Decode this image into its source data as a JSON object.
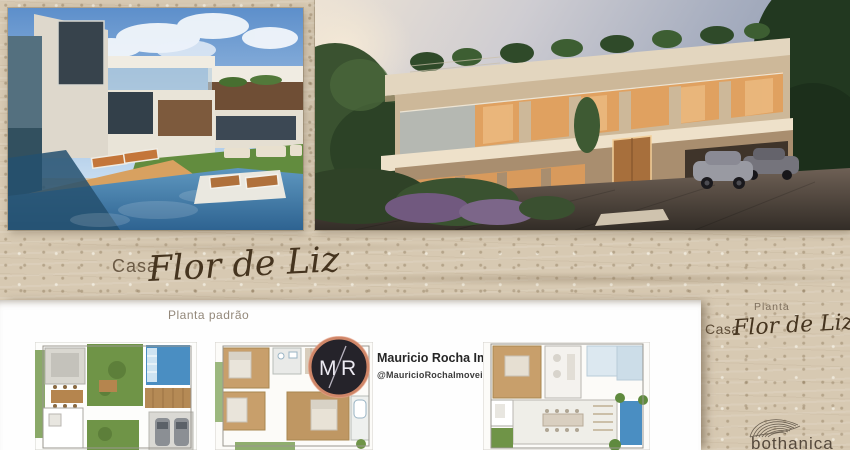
{
  "banner": {
    "casa": "Casa",
    "title": "Flor de Liz"
  },
  "plans_panel": {
    "caption": "Planta padrão"
  },
  "sidebar": {
    "planta": "Planta",
    "casa": "Casa",
    "title": "Flor de Liz",
    "brand": "bothanica"
  },
  "realtor": {
    "name": "Mauricio Rocha Imóveis",
    "handle": "@MauricioRochaImoveis",
    "monogram": {
      "m": "M",
      "r": "R"
    }
  },
  "media": {
    "photo_day": "exterior-pool-day-render",
    "photo_dusk": "facade-dusk-render",
    "plan_ground": "floor-plan-ground",
    "plan_upper": "floor-plan-upper",
    "plan_terrace": "floor-plan-terrace"
  },
  "colors": {
    "travertine": "#d7c9b2",
    "panel_white": "#fefefe",
    "ink_brown": "#45341f",
    "caption_gray": "#93887a",
    "copper_ring": "#cf8668",
    "logo_dark": "#25232a",
    "pool_blue": "#4a8ec2",
    "grass_green": "#6f9447",
    "window_amber": "#e0a160"
  }
}
